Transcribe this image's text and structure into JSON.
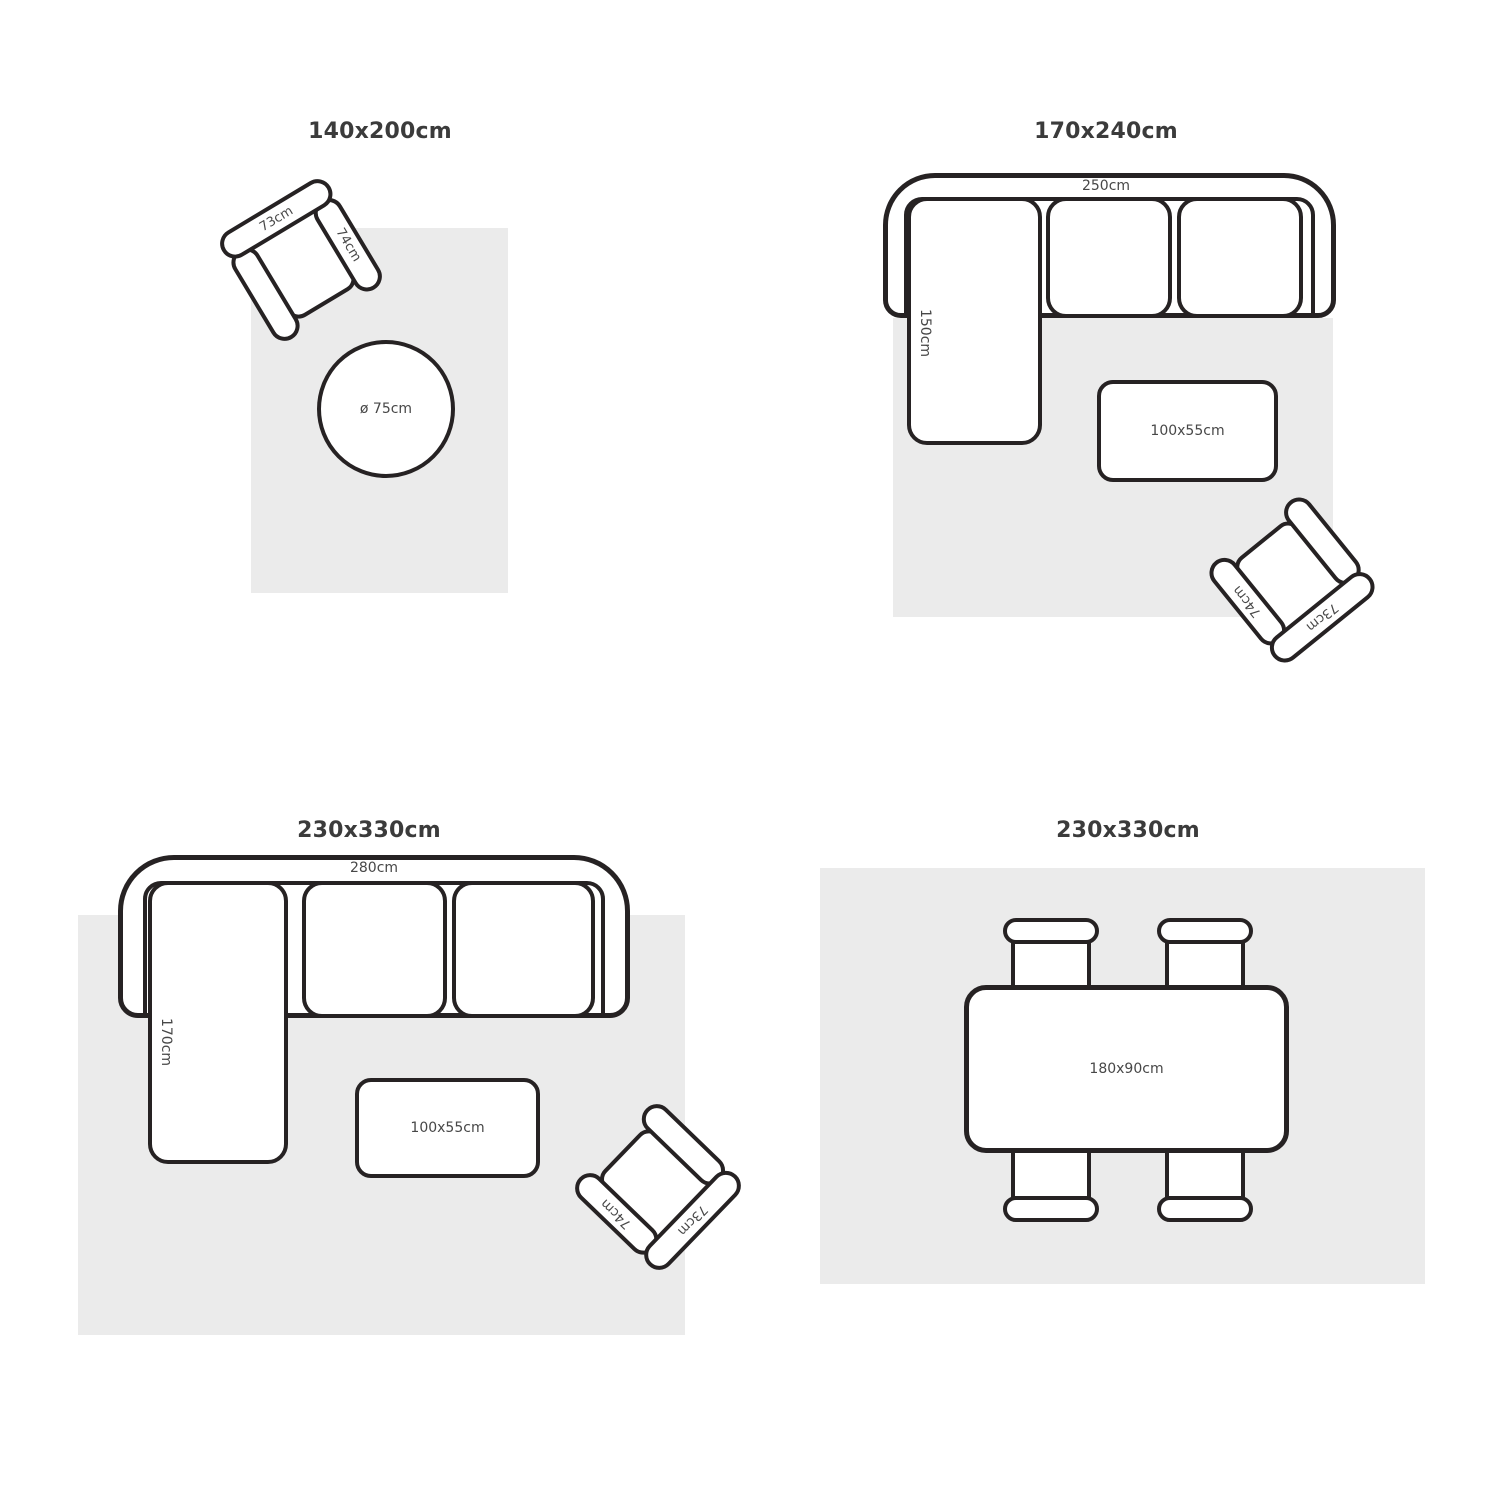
{
  "colors": {
    "outline": "#262223",
    "rug": "#ebebeb",
    "title_text": "#3b3b3b",
    "label_text": "#474747",
    "background": "#ffffff"
  },
  "panels": {
    "top_left": {
      "title": "140x200cm",
      "armchair": {
        "back": "73cm",
        "arm": "74cm"
      },
      "round_table": "ø 75cm"
    },
    "top_right": {
      "title": "170x240cm",
      "sofa": {
        "width": "250cm",
        "depth": "150cm"
      },
      "coffee_table": "100x55cm",
      "armchair": {
        "back": "73cm",
        "arm": "74cm"
      }
    },
    "bottom_left": {
      "title": "230x330cm",
      "sofa": {
        "width": "280cm",
        "depth": "170cm"
      },
      "coffee_table": "100x55cm",
      "armchair": {
        "back": "73cm",
        "arm": "74cm"
      }
    },
    "bottom_right": {
      "title": "230x330cm",
      "dining_table": "180x90cm"
    }
  }
}
